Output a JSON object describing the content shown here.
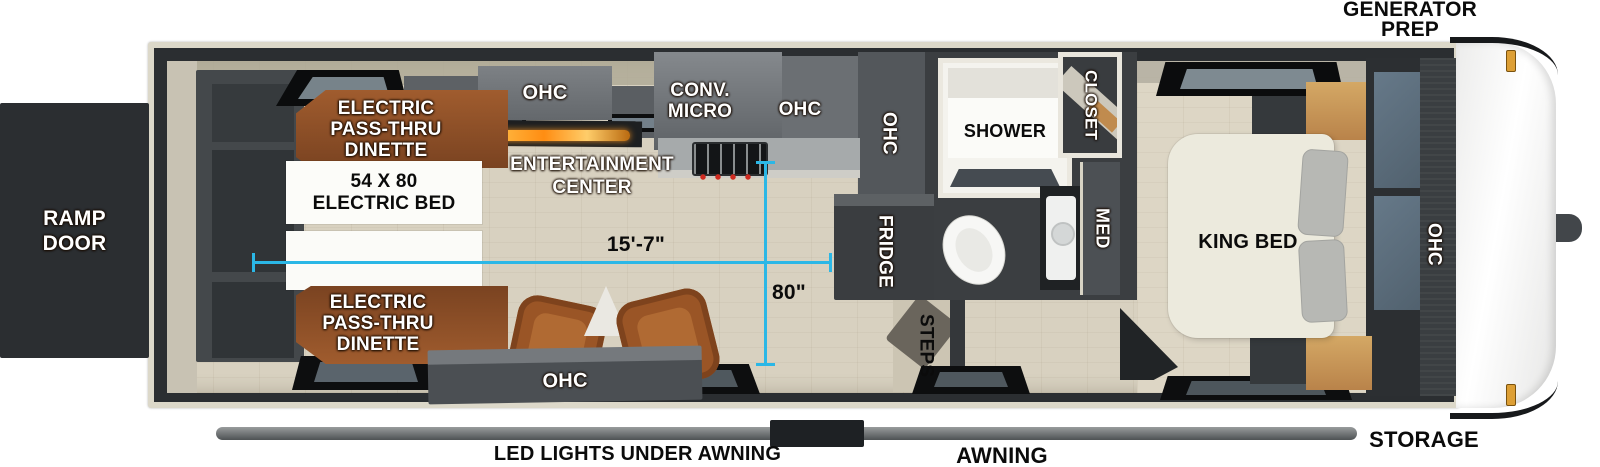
{
  "page": {
    "width": 1600,
    "height": 467,
    "background": "#ffffff"
  },
  "colors": {
    "accent_cyan": "#2bb7e6",
    "wall_dark": "#2b2e31",
    "frame_beige": "#dcd8c9",
    "floor_wood": "#d8d1c0",
    "dinette_brown": "#96552b",
    "cabinet_gray": "#6a6e72",
    "cabinet_dark": "#3a3d40",
    "oak_wood": "#c79253",
    "cap_white": "#f4f4f3",
    "marker_amber": "#dd9f35"
  },
  "exterior": {
    "generator_prep_lines": [
      "GENERATOR",
      "PREP"
    ],
    "ramp_door_lines": [
      "RAMP",
      "DOOR"
    ],
    "storage": "STORAGE",
    "awning": "AWNING",
    "led_lights": "LED LIGHTS UNDER AWNING"
  },
  "garage": {
    "dinette_top_lines": [
      "ELECTRIC",
      "PASS-THRU",
      "DINETTE"
    ],
    "electric_bed_lines": [
      "54 X 80",
      "ELECTRIC BED"
    ],
    "dinette_bottom_lines": [
      "ELECTRIC",
      "PASS-THRU",
      "DINETTE"
    ],
    "entertainment_lines": [
      "ENTERTAINMENT",
      "CENTER"
    ],
    "ohc_overhead": "OHC",
    "ohc_island": "OHC"
  },
  "kitchen": {
    "conv_micro_lines": [
      "CONV.",
      "MICRO"
    ],
    "ohc_upper": "OHC",
    "ohc_pantry": "OHC",
    "fridge": "FRIDGE",
    "steps": "STEPS"
  },
  "bathroom": {
    "shower": "SHOWER",
    "closet": "CLOSET",
    "med": "MED"
  },
  "bedroom": {
    "king_bed": "KING BED",
    "ohc": "OHC"
  },
  "measurements": {
    "interior_length": "15'-7\"",
    "interior_width": "80\""
  }
}
